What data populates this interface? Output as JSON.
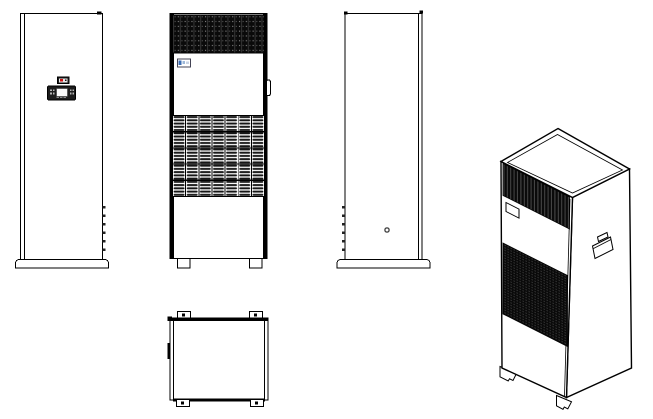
{
  "canvas": {
    "width": 653,
    "height": 419,
    "background": "#ffffff"
  },
  "colors": {
    "line": "#000000",
    "fill": "#ffffff",
    "grille_dark": "#0a0a0a",
    "grille_texture": "#8a8a8a",
    "louver_slat": "#161616",
    "controller_body": "#1c1c1c",
    "screen": "#fafafa",
    "led_red": "#cc1111",
    "logo_blue": "#3b6db4",
    "logo_blue_light": "#9db8d8"
  },
  "views": {
    "front_controller": {
      "name": "front-view-with-controller-panel"
    },
    "front_grilles": {
      "name": "front-view-with-air-grilles"
    },
    "rear": {
      "name": "rear-side-view"
    },
    "top": {
      "name": "top-plan-view"
    },
    "isometric": {
      "name": "isometric-perspective-view"
    }
  }
}
